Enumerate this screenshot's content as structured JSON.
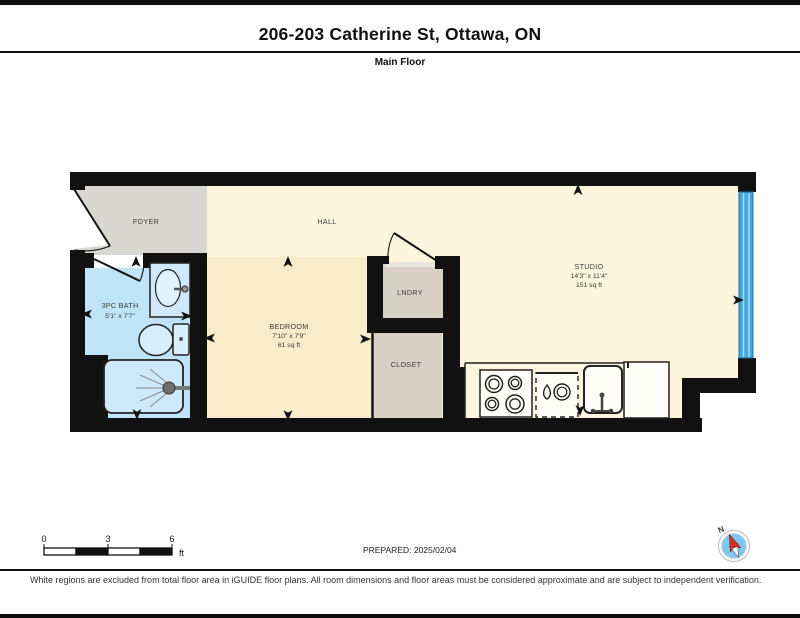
{
  "header": {
    "title": "206-203 Catherine St, Ottawa, ON",
    "subtitle": "Main Floor"
  },
  "plan": {
    "rooms": {
      "foyer": {
        "label": "FOYER"
      },
      "hall": {
        "label": "HALL"
      },
      "bath": {
        "label": "3PC BATH",
        "dims": "5'1\" x 7'7\""
      },
      "bedroom": {
        "label": "BEDROOM",
        "dims": "7'10\" x 7'9\"",
        "area": "61 sq ft"
      },
      "laundry": {
        "label": "LNDRY"
      },
      "closet": {
        "label": "CLOSET"
      },
      "studio": {
        "label": "STUDIO",
        "dims": "14'3\" x 11'4\"",
        "area": "151 sq ft"
      }
    }
  },
  "scale_bar": {
    "tick_0": "0",
    "tick_3": "3",
    "tick_6": "6",
    "unit": "ft"
  },
  "prepared": {
    "label": "PREPARED: 2025/02/04"
  },
  "compass": {
    "north_label": "N"
  },
  "footer": {
    "disclaimer": "White regions are excluded from total floor area in iGUIDE floor plans. All room dimensions and floor areas must be considered approximate and are subject to independent verification."
  },
  "colors": {
    "wall": "#111111",
    "hall_studio_fill": "#fdf5dd",
    "bedroom_fill": "#f8ecca",
    "foyer_fill": "#d9d7d2",
    "laundry_closet_fill": "#d7d1c5",
    "bath_fill": "#bfe3f7",
    "window_blue": "#41a9dc",
    "compass_needle_red": "#d93025"
  }
}
